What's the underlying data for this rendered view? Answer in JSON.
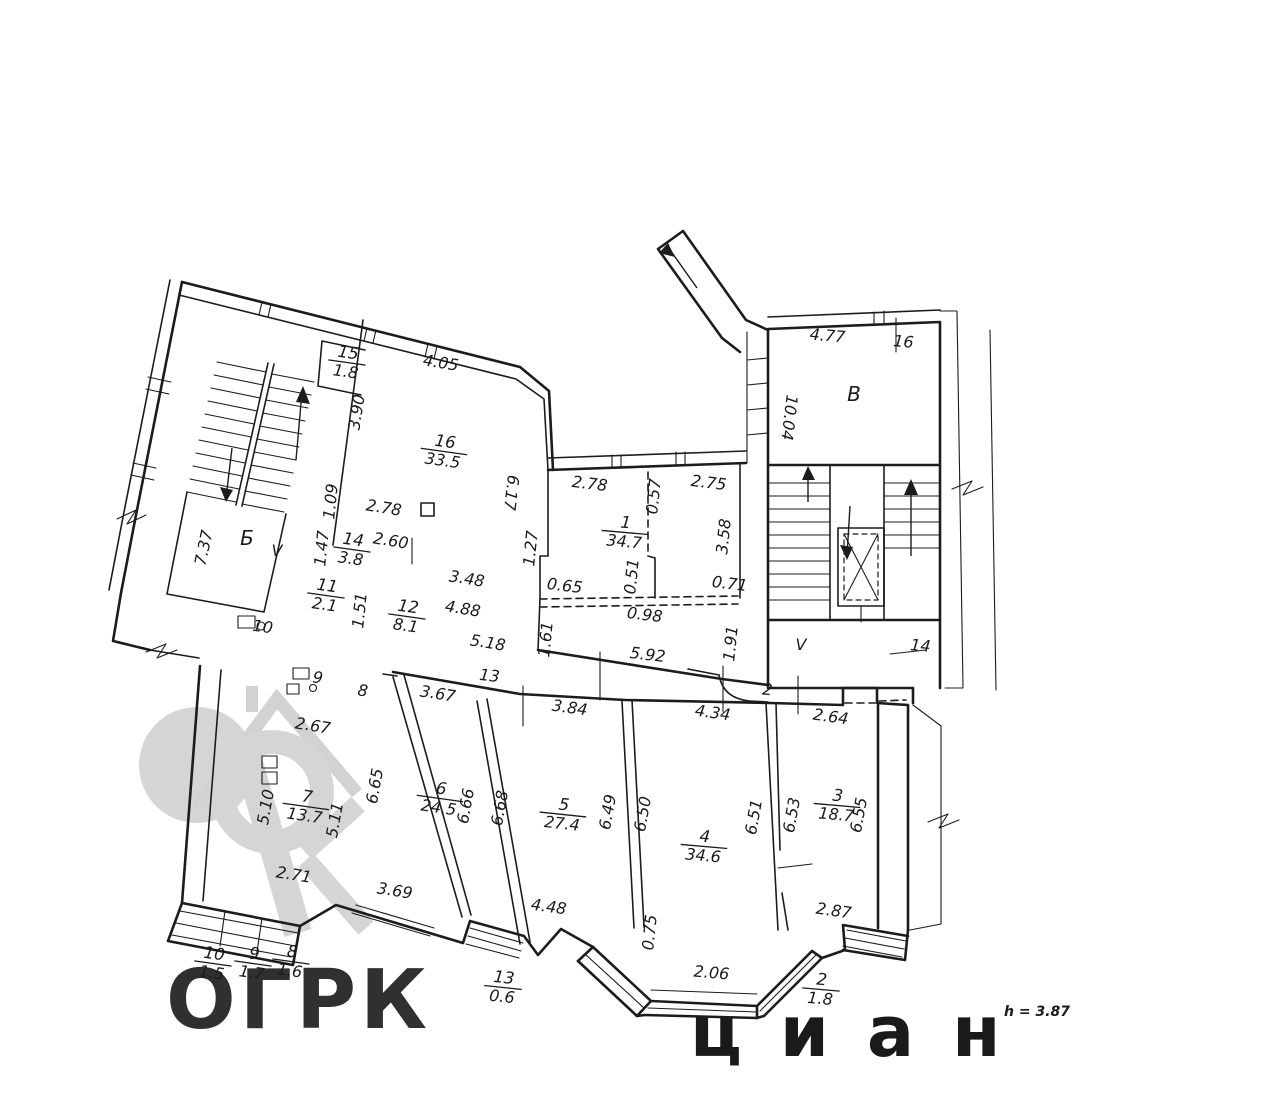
{
  "plan": {
    "note_height": "h = 3.87",
    "watermark": {
      "text": "ОГРК",
      "faint_text": "циан"
    },
    "rooms": [
      {
        "n": "15",
        "a": "1.8",
        "x": 347,
        "y": 362,
        "ang": 8
      },
      {
        "n": "16",
        "a": "33.5",
        "x": 444,
        "y": 451,
        "ang": 8
      },
      {
        "n": "1",
        "a": "34.7",
        "x": 625,
        "y": 532,
        "ang": 5
      },
      {
        "n": "14",
        "a": "3.8",
        "x": 352,
        "y": 549,
        "ang": 8
      },
      {
        "n": "11",
        "a": "2.1",
        "x": 326,
        "y": 595,
        "ang": 8
      },
      {
        "n": "12",
        "a": "8.1",
        "x": 407,
        "y": 616,
        "ang": 8
      },
      {
        "n": "7",
        "a": "13.7",
        "x": 306,
        "y": 806,
        "ang": 8
      },
      {
        "n": "6",
        "a": "24.5",
        "x": 440,
        "y": 798,
        "ang": 8
      },
      {
        "n": "5",
        "a": "27.4",
        "x": 563,
        "y": 814,
        "ang": 6
      },
      {
        "n": "4",
        "a": "34.6",
        "x": 704,
        "y": 846,
        "ang": 5
      },
      {
        "n": "3",
        "a": "18.7",
        "x": 837,
        "y": 805,
        "ang": 5
      },
      {
        "n": "10",
        "a": "1.5",
        "x": 213,
        "y": 963,
        "ang": 8
      },
      {
        "n": "9",
        "a": "1.7",
        "x": 253,
        "y": 963,
        "ang": 8
      },
      {
        "n": "8",
        "a": "1.6",
        "x": 291,
        "y": 961,
        "ang": 8
      },
      {
        "n": "13",
        "a": "0.6",
        "x": 503,
        "y": 987,
        "ang": 6
      },
      {
        "n": "2",
        "a": "1.8",
        "x": 821,
        "y": 989,
        "ang": 5
      }
    ],
    "dims": [
      {
        "v": "4.05",
        "x": 440,
        "y": 368,
        "a": 9
      },
      {
        "v": "3.90",
        "x": 362,
        "y": 413,
        "a": -81
      },
      {
        "v": "2.78",
        "x": 383,
        "y": 513,
        "a": 9
      },
      {
        "v": "2.60",
        "x": 390,
        "y": 546,
        "a": 9
      },
      {
        "v": "1.09",
        "x": 336,
        "y": 502,
        "a": -84
      },
      {
        "v": "1.47",
        "x": 327,
        "y": 549,
        "a": -84
      },
      {
        "v": "7.37",
        "x": 209,
        "y": 549,
        "a": -78
      },
      {
        "v": "3.48",
        "x": 466,
        "y": 584,
        "a": 9
      },
      {
        "v": "4.88",
        "x": 462,
        "y": 614,
        "a": 9
      },
      {
        "v": "5.18",
        "x": 487,
        "y": 648,
        "a": 9
      },
      {
        "v": "1.51",
        "x": 365,
        "y": 611,
        "a": -84
      },
      {
        "v": "2.67",
        "x": 312,
        "y": 731,
        "a": 9
      },
      {
        "v": "2.71",
        "x": 293,
        "y": 880,
        "a": 9
      },
      {
        "v": "3.69",
        "x": 394,
        "y": 896,
        "a": 9
      },
      {
        "v": "5.10",
        "x": 271,
        "y": 808,
        "a": -80
      },
      {
        "v": "5.11",
        "x": 340,
        "y": 821,
        "a": -80
      },
      {
        "v": "6.65",
        "x": 380,
        "y": 787,
        "a": -80
      },
      {
        "v": "6.66",
        "x": 471,
        "y": 807,
        "a": -80
      },
      {
        "v": "6.68",
        "x": 505,
        "y": 809,
        "a": -80
      },
      {
        "v": "3.67",
        "x": 437,
        "y": 699,
        "a": 9
      },
      {
        "v": "6.17",
        "x": 506,
        "y": 492,
        "a": 97
      },
      {
        "v": "1.27",
        "x": 536,
        "y": 549,
        "a": -84
      },
      {
        "v": "0.65",
        "x": 564,
        "y": 591,
        "a": 7
      },
      {
        "v": "2.78",
        "x": 589,
        "y": 489,
        "a": 7
      },
      {
        "v": "0.57",
        "x": 659,
        "y": 497,
        "a": -84
      },
      {
        "v": "2.75",
        "x": 708,
        "y": 488,
        "a": 7
      },
      {
        "v": "0.51",
        "x": 637,
        "y": 577,
        "a": -84
      },
      {
        "v": "3.58",
        "x": 729,
        "y": 537,
        "a": -84
      },
      {
        "v": "0.71",
        "x": 729,
        "y": 589,
        "a": 7
      },
      {
        "v": "0.98",
        "x": 644,
        "y": 620,
        "a": 7
      },
      {
        "v": "5.92",
        "x": 647,
        "y": 660,
        "a": 7
      },
      {
        "v": "1.61",
        "x": 551,
        "y": 640,
        "a": -84
      },
      {
        "v": "1.91",
        "x": 736,
        "y": 644,
        "a": -84
      },
      {
        "v": "3.84",
        "x": 569,
        "y": 713,
        "a": 8
      },
      {
        "v": "4.34",
        "x": 712,
        "y": 718,
        "a": 8
      },
      {
        "v": "2.64",
        "x": 830,
        "y": 722,
        "a": 8
      },
      {
        "v": "4.77",
        "x": 827,
        "y": 341,
        "a": 5
      },
      {
        "v": "10.04",
        "x": 784,
        "y": 417,
        "a": 97
      },
      {
        "v": "6.49",
        "x": 613,
        "y": 813,
        "a": -80
      },
      {
        "v": "6.50",
        "x": 648,
        "y": 815,
        "a": -80
      },
      {
        "v": "6.51",
        "x": 759,
        "y": 818,
        "a": -80
      },
      {
        "v": "6.53",
        "x": 797,
        "y": 816,
        "a": -80
      },
      {
        "v": "6.55",
        "x": 864,
        "y": 816,
        "a": -80
      },
      {
        "v": "4.48",
        "x": 548,
        "y": 912,
        "a": 8
      },
      {
        "v": "0.75",
        "x": 655,
        "y": 933,
        "a": -84
      },
      {
        "v": "2.06",
        "x": 711,
        "y": 978,
        "a": 5
      },
      {
        "v": "2.87",
        "x": 833,
        "y": 916,
        "a": 8
      }
    ],
    "labels": [
      {
        "t": "Б",
        "x": 247,
        "y": 545,
        "cls": "big",
        "a": 0
      },
      {
        "t": "V",
        "x": 277,
        "y": 556,
        "cls": "plain",
        "a": 0
      },
      {
        "t": "10",
        "x": 262,
        "y": 632,
        "cls": "plain",
        "a": 8
      },
      {
        "t": "9",
        "x": 317,
        "y": 683,
        "cls": "plain",
        "a": 8
      },
      {
        "t": "8",
        "x": 362,
        "y": 696,
        "cls": "plain",
        "a": 8
      },
      {
        "t": "13",
        "x": 489,
        "y": 681,
        "cls": "plain",
        "a": 6
      },
      {
        "t": "16",
        "x": 903,
        "y": 347,
        "cls": "plain",
        "a": 5
      },
      {
        "t": "В",
        "x": 854,
        "y": 401,
        "cls": "big",
        "a": 0
      },
      {
        "t": "V",
        "x": 801,
        "y": 650,
        "cls": "plain",
        "a": 0
      },
      {
        "t": "14",
        "x": 920,
        "y": 651,
        "cls": "plain",
        "a": 5
      },
      {
        "t": "2",
        "x": 767,
        "y": 695,
        "cls": "plain",
        "a": 5
      },
      {
        "t": "h = 3.87",
        "x": 1037,
        "y": 1016,
        "cls": "note",
        "a": 0
      }
    ]
  }
}
